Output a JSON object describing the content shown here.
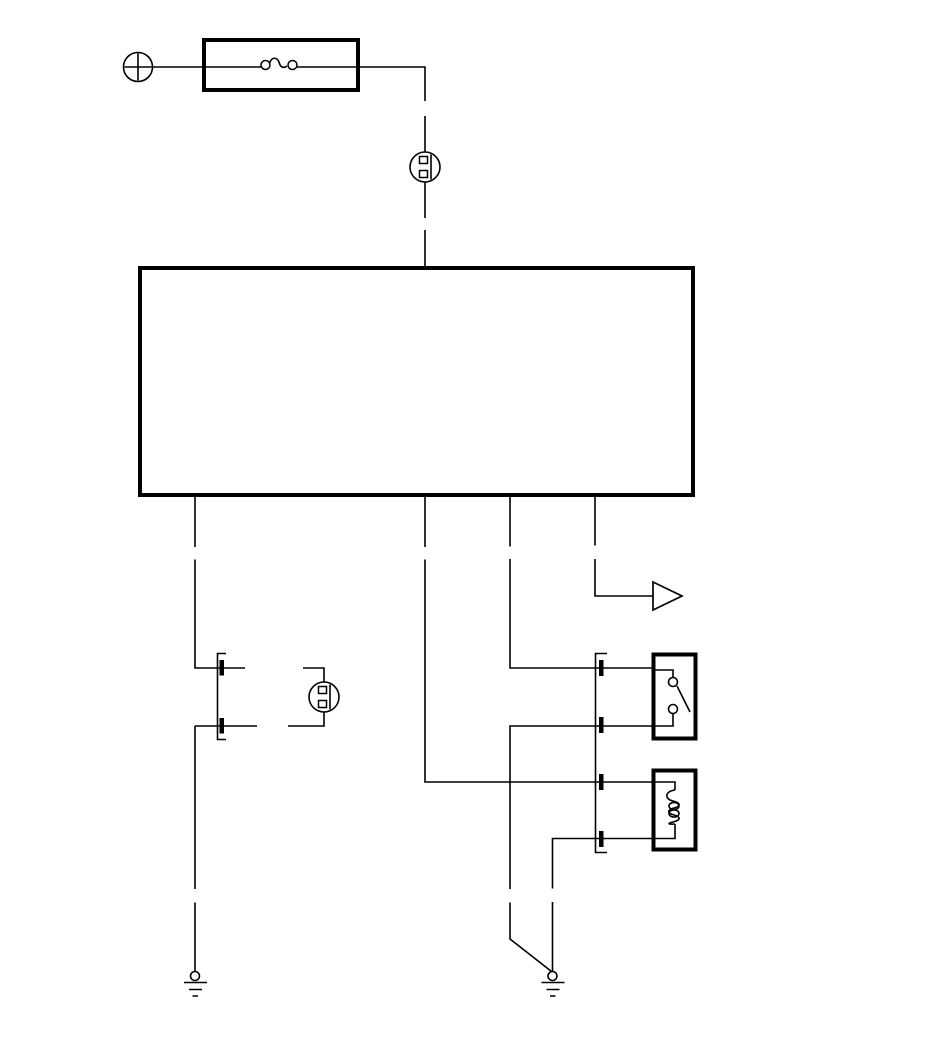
{
  "diagram": {
    "type": "automotive-wiring-schematic",
    "background_color": "#ffffff",
    "line_color": "#000000",
    "canvas": {
      "width": 950,
      "height": 1040
    },
    "components": [
      {
        "id": "power-source",
        "symbol": "circle-with-plus",
        "style": "outline"
      },
      {
        "id": "fuse",
        "symbol": "fuse-element-in-thick-box",
        "style": "thick-outline-box"
      },
      {
        "id": "inline-connector-top",
        "symbol": "circle-connector-two-pin",
        "pins": 2
      },
      {
        "id": "control-unit",
        "symbol": "large-empty-thick-rectangle",
        "outputs": 4
      },
      {
        "id": "switch",
        "symbol": "two-terminal-connector-with-pin-bars",
        "pins": 2
      },
      {
        "id": "inline-connector-switch",
        "symbol": "circle-connector-two-pin",
        "pins": 2
      },
      {
        "id": "signal-arrow",
        "symbol": "open-right-triangle-arrow"
      },
      {
        "id": "multi-pin-connector",
        "symbol": "bracket-connector-with-pin-bars",
        "pins": 4
      },
      {
        "id": "relay-contact",
        "symbol": "open-contact-in-thick-box",
        "terminals": 2
      },
      {
        "id": "solenoid-coil",
        "symbol": "coil-in-thick-box",
        "terminals": 2
      },
      {
        "id": "ground-left",
        "symbol": "chassis-ground"
      },
      {
        "id": "ground-right",
        "symbol": "chassis-ground"
      }
    ],
    "wire_style": {
      "pattern": "long-dash-with-breaks",
      "color": "#000000"
    }
  }
}
